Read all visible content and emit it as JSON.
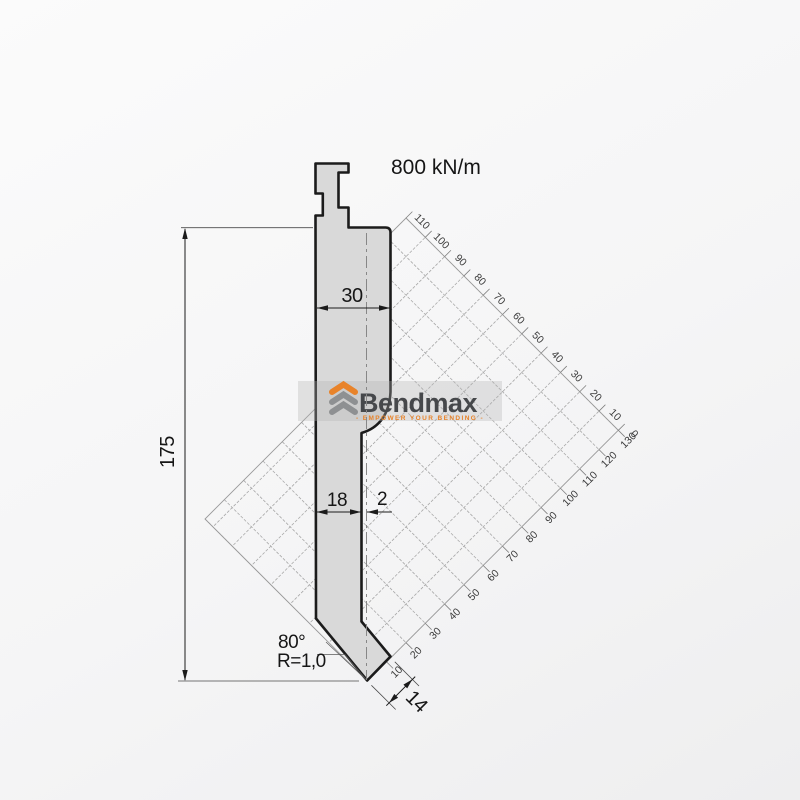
{
  "drawing": {
    "force_rating": "800 kN/m",
    "dim_height": "175",
    "dim_body_width": "30",
    "dim_shaft_width": "18",
    "dim_offset": "2",
    "dim_tip_flat": "14",
    "tip_angle": "80°",
    "tip_radius": "R=1,0"
  },
  "logo": {
    "brand": "Bendmax",
    "tagline": "- EMPOWER YOUR BENDING -"
  },
  "grid": {
    "top_labels": [
      "110",
      "100",
      "90",
      "80",
      "70",
      "60",
      "50",
      "40",
      "30",
      "20",
      "10",
      "0"
    ],
    "bottom_labels": [
      "10",
      "20",
      "30",
      "40",
      "50",
      "60",
      "70",
      "80",
      "90",
      "100",
      "110",
      "120",
      "130"
    ]
  },
  "colors": {
    "accent_orange": "#e8832a",
    "logo_gray": "#8e9092",
    "punch_fill": "#d9d9d9",
    "outline": "#1b1b1b",
    "grid_line": "#a8a8a8"
  }
}
